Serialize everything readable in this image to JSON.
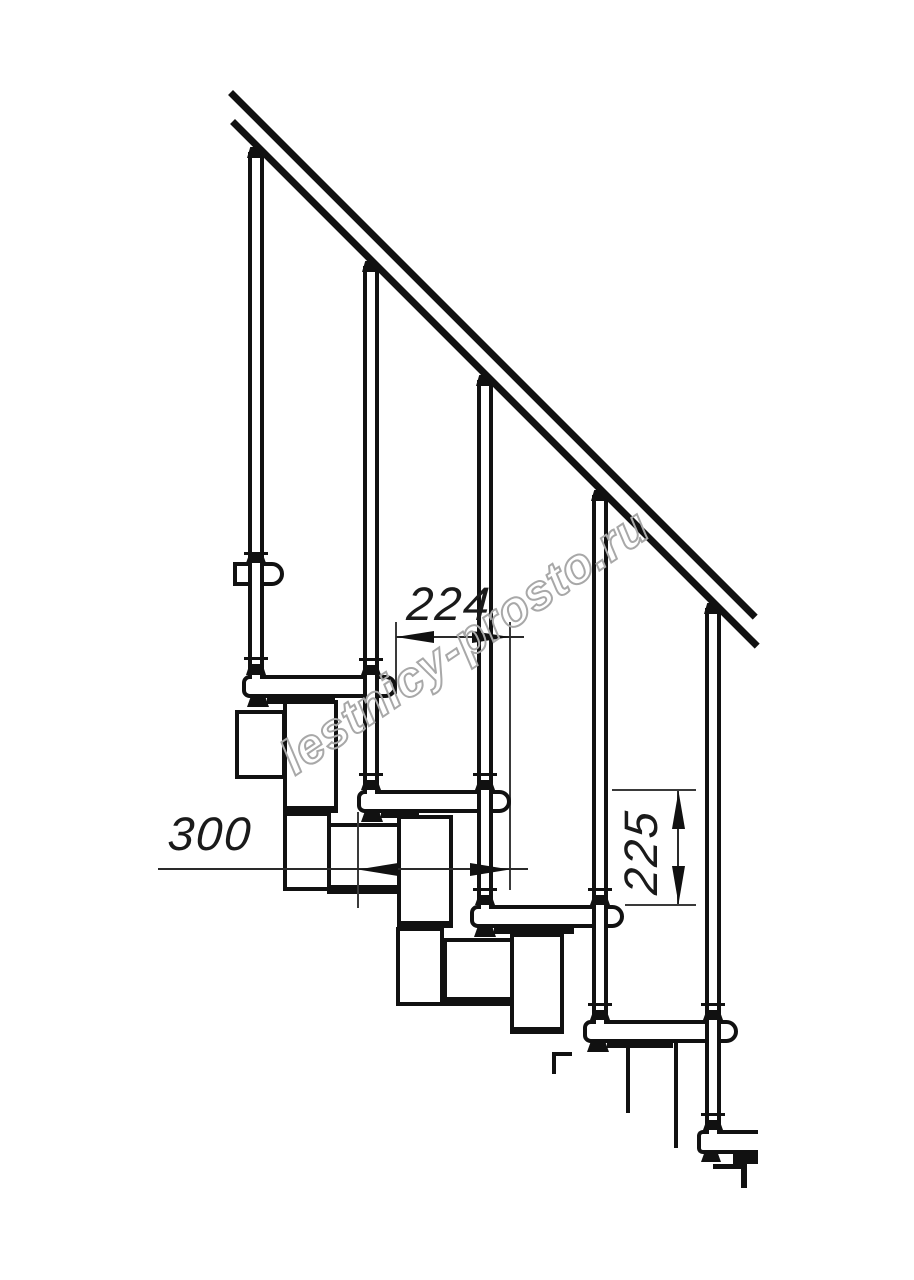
{
  "drawing": {
    "title": "modular-staircase-side-view",
    "watermark": "lestnicy-prosto.ru",
    "dimensions": {
      "step_run_offset": "224",
      "tread_depth": "300",
      "step_rise": "225"
    },
    "colors": {
      "line": "#111111",
      "thin_line": "#3a3a3a",
      "dimension_text": "#1a1a1a",
      "watermark_outline": "#a8a8a8",
      "background": "#ffffff"
    }
  }
}
